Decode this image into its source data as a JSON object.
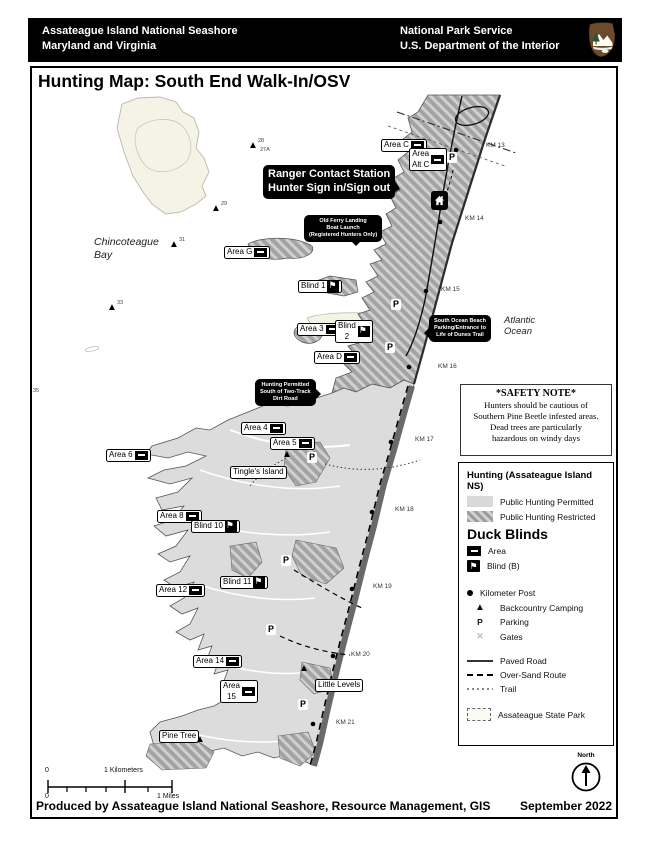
{
  "header": {
    "left_line1": "Assateague Island National Seashore",
    "left_line2": "Maryland and Virginia",
    "right_line1": "National Park Service",
    "right_line2": "U.S. Department of the Interior",
    "logo": "nps-arrowhead"
  },
  "title": "Hunting Map: South End Walk-In/OSV",
  "colors": {
    "permitted": "#d9d9d9",
    "restricted_dark": "#9c9c9c",
    "restricted_light": "#d2d2d2",
    "cream_island": "#f4f3e6",
    "shore_band": "#6a6a6a",
    "callout_bg": "#000000"
  },
  "icons": {
    "parking": "P",
    "camp": "▲",
    "gates": "✕",
    "blind_flag": "⚑",
    "north_arrow": "↑",
    "km_post": "●"
  },
  "map": {
    "items": [
      {
        "type": "box",
        "text": "Area C",
        "x": 381,
        "y": 139,
        "marker": "area"
      },
      {
        "type": "box",
        "lines": [
          "Area",
          "Alt C"
        ],
        "x": 409,
        "y": 148,
        "marker": "area"
      },
      {
        "type": "box",
        "text": "Area G",
        "x": 224,
        "y": 246,
        "marker": "area"
      },
      {
        "type": "box",
        "text": "Blind 1",
        "x": 298,
        "y": 280,
        "marker": "blind"
      },
      {
        "type": "box",
        "text": "Area 3",
        "x": 297,
        "y": 323,
        "marker": "area"
      },
      {
        "type": "box",
        "lines": [
          "Blind",
          "2"
        ],
        "x": 335,
        "y": 320,
        "marker": "blind"
      },
      {
        "type": "box",
        "text": "Area D",
        "x": 314,
        "y": 351,
        "marker": "area"
      },
      {
        "type": "box",
        "text": "Area 4",
        "x": 241,
        "y": 422,
        "marker": "area"
      },
      {
        "type": "box",
        "text": "Area 5",
        "x": 270,
        "y": 437,
        "marker": "area"
      },
      {
        "type": "box",
        "text": "Area 6",
        "x": 106,
        "y": 449,
        "marker": "area"
      },
      {
        "type": "box",
        "text": "Tingle's Island",
        "x": 230,
        "y": 466
      },
      {
        "type": "box",
        "text": "Area 8",
        "x": 157,
        "y": 510,
        "marker": "area"
      },
      {
        "type": "box",
        "text": "Blind 10",
        "x": 191,
        "y": 520,
        "marker": "blind"
      },
      {
        "type": "box",
        "text": "Blind 11",
        "x": 220,
        "y": 576,
        "marker": "blind"
      },
      {
        "type": "box",
        "text": "Area 12",
        "x": 156,
        "y": 584,
        "marker": "area"
      },
      {
        "type": "box",
        "text": "Area 14",
        "x": 193,
        "y": 655,
        "marker": "area"
      },
      {
        "type": "box",
        "lines": [
          "Area",
          "15"
        ],
        "x": 220,
        "y": 680,
        "marker": "area"
      },
      {
        "type": "box",
        "text": "Little Levels",
        "x": 315,
        "y": 679
      },
      {
        "type": "box",
        "text": "Pine Tree",
        "x": 159,
        "y": 730
      },
      {
        "type": "callout",
        "lines": [
          "Ranger Contact Station",
          "Hunter Sign in/Sign out"
        ],
        "x": 263,
        "y": 165,
        "fs": 11,
        "pt": "br"
      },
      {
        "type": "callout",
        "lines": [
          "Old Ferry Landing",
          "Boat Launch",
          "(Registered Hunters Only)"
        ],
        "x": 304,
        "y": 215,
        "fs": 5.5,
        "pt": "bl"
      },
      {
        "type": "callout",
        "lines": [
          "South Ocean Beach",
          "Parking/Entrance to",
          "Life of Dunes Trail"
        ],
        "x": 429,
        "y": 315,
        "fs": 5.5,
        "pt": "l"
      },
      {
        "type": "callout",
        "lines": [
          "Hunting Permitted",
          "South of Two-Track",
          "Dirt Road"
        ],
        "x": 255,
        "y": 379,
        "fs": 5.5,
        "pt": "r"
      },
      {
        "type": "km",
        "text": "KM 13",
        "x": 486,
        "y": 142
      },
      {
        "type": "km",
        "text": "KM 14",
        "x": 465,
        "y": 215
      },
      {
        "type": "km",
        "text": "KM 15",
        "x": 441,
        "y": 286
      },
      {
        "type": "km",
        "text": "KM 16",
        "x": 438,
        "y": 363
      },
      {
        "type": "km",
        "text": "KM 17",
        "x": 415,
        "y": 436
      },
      {
        "type": "km",
        "text": "KM 18",
        "x": 395,
        "y": 506
      },
      {
        "type": "km",
        "text": "KM 19",
        "x": 373,
        "y": 583
      },
      {
        "type": "km",
        "text": "KM 20",
        "x": 351,
        "y": 651
      },
      {
        "type": "km",
        "text": "KM 21",
        "x": 336,
        "y": 719
      },
      {
        "type": "sea",
        "lines": [
          "Chincoteague",
          "Bay"
        ],
        "x": 94,
        "y": 236,
        "fs": 10.5
      },
      {
        "type": "sea",
        "lines": [
          "Atlantic",
          "Ocean"
        ],
        "x": 504,
        "y": 315,
        "fs": 9.5
      },
      {
        "type": "p",
        "x": 447,
        "y": 152
      },
      {
        "type": "p",
        "x": 391,
        "y": 299
      },
      {
        "type": "p",
        "x": 385,
        "y": 342
      },
      {
        "type": "p",
        "x": 307,
        "y": 452
      },
      {
        "type": "p",
        "x": 281,
        "y": 555
      },
      {
        "type": "p",
        "x": 266,
        "y": 624
      },
      {
        "type": "p",
        "x": 298,
        "y": 699
      },
      {
        "type": "camp",
        "x": 248,
        "y": 141
      },
      {
        "type": "camp",
        "x": 211,
        "y": 204
      },
      {
        "type": "camp",
        "x": 169,
        "y": 240
      },
      {
        "type": "camp",
        "x": 107,
        "y": 303
      },
      {
        "type": "camp",
        "x": 282,
        "y": 450
      },
      {
        "type": "camp",
        "x": 299,
        "y": 664
      },
      {
        "type": "camp",
        "x": 195,
        "y": 735
      },
      {
        "type": "num",
        "text": "28",
        "x": 258,
        "y": 138
      },
      {
        "type": "num",
        "text": "27A",
        "x": 260,
        "y": 147
      },
      {
        "type": "num",
        "text": "29",
        "x": 221,
        "y": 201
      },
      {
        "type": "num",
        "text": "31",
        "x": 179,
        "y": 237
      },
      {
        "type": "num",
        "text": "33",
        "x": 117,
        "y": 300
      },
      {
        "type": "num",
        "text": "35",
        "x": 33,
        "y": 388
      },
      {
        "type": "station",
        "x": 431,
        "y": 191
      }
    ]
  },
  "safety": {
    "title": "*SAFETY NOTE*",
    "lines": [
      "Hunters should be cautious of",
      "Southern Pine Beetle infested areas.",
      "Dead trees are particularly",
      "hazardous on windy days"
    ]
  },
  "legend": {
    "groups": [
      {
        "title": "Hunting (Assateague Island NS)",
        "style": "small",
        "cls": "g1",
        "items": [
          {
            "icon": "swatch-permitted",
            "label": "Public Hunting Permitted"
          },
          {
            "icon": "swatch-restricted",
            "label": "Public Hunting Restricted"
          }
        ]
      },
      {
        "title": "Duck Blinds",
        "style": "big",
        "cls": "g2",
        "items": [
          {
            "icon": "marker-area",
            "label": "Area"
          },
          {
            "icon": "marker-blind",
            "label": "Blind  (B)"
          }
        ]
      },
      {
        "cls": "g3",
        "items": [
          {
            "icon": "km-post",
            "label": "Kilometer Post"
          },
          {
            "icon": "camp",
            "label": "Backcountry Camping"
          },
          {
            "icon": "parking",
            "label": "Parking"
          },
          {
            "icon": "gates",
            "label": "Gates"
          }
        ]
      },
      {
        "cls": "g4",
        "items": [
          {
            "icon": "paved-road",
            "label": "Paved Road"
          },
          {
            "icon": "over-sand",
            "label": "Over-Sand Route"
          },
          {
            "icon": "trail",
            "label": "Trail"
          }
        ]
      },
      {
        "cls": "g5",
        "items": [
          {
            "icon": "state-park",
            "label": "Assateague State Park"
          }
        ]
      }
    ]
  },
  "scale": {
    "zero_top": "0",
    "km_label": "1 Kilometers",
    "zero_bottom": "0",
    "miles_label": "1 Miles"
  },
  "footer": {
    "credit": "Produced by Assateague Island National Seashore, Resource Management, GIS",
    "date": "September 2022",
    "north_label": "North"
  }
}
